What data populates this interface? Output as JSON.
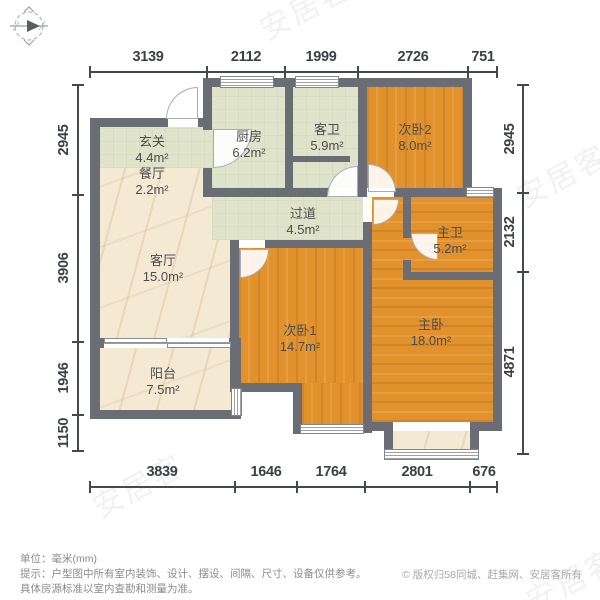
{
  "meta": {
    "unit_note": "单位：毫米(mm)",
    "disclaimer1": "提示：户型图中所有室内装饰、设计、摆设、间隔、尺寸、设备仅供参考。",
    "disclaimer2": "具体房源标准以室内查勘和测量为准。",
    "copyright": "© 版权归58同城、赶集网、安居客所有",
    "watermark": "安居客"
  },
  "rooms": [
    {
      "id": "entry",
      "name": "玄关",
      "area": "4.4m²"
    },
    {
      "id": "dining",
      "name": "餐厅",
      "area": "2.2m²"
    },
    {
      "id": "kitchen",
      "name": "厨房",
      "area": "6.2m²"
    },
    {
      "id": "guest-bath",
      "name": "客卫",
      "area": "5.9m²"
    },
    {
      "id": "bedroom2",
      "name": "次卧2",
      "area": "8.0m²"
    },
    {
      "id": "corridor",
      "name": "过道",
      "area": "4.5m²"
    },
    {
      "id": "master-bath",
      "name": "主卫",
      "area": "5.2m²"
    },
    {
      "id": "living",
      "name": "客厅",
      "area": "15.0m²"
    },
    {
      "id": "bedroom1",
      "name": "次卧1",
      "area": "14.7m²"
    },
    {
      "id": "master-bedroom",
      "name": "主卧",
      "area": "18.0m²"
    },
    {
      "id": "balcony",
      "name": "阳台",
      "area": "7.5m²"
    }
  ],
  "dimensions": {
    "top": [
      "3139",
      "2112",
      "1999",
      "2726",
      "751"
    ],
    "bottom": [
      "3839",
      "1646",
      "1764",
      "2801",
      "676"
    ],
    "left": [
      "2945",
      "3906",
      "1946",
      "1150"
    ],
    "right": [
      "2945",
      "2132",
      "4871"
    ]
  },
  "colors": {
    "wall": "#6a6e74",
    "wood_floor": "#e2922d",
    "tile_floor": "#dee3c9",
    "marble_floor": "#f4e9d3",
    "dimension_text": "#3d4043"
  }
}
